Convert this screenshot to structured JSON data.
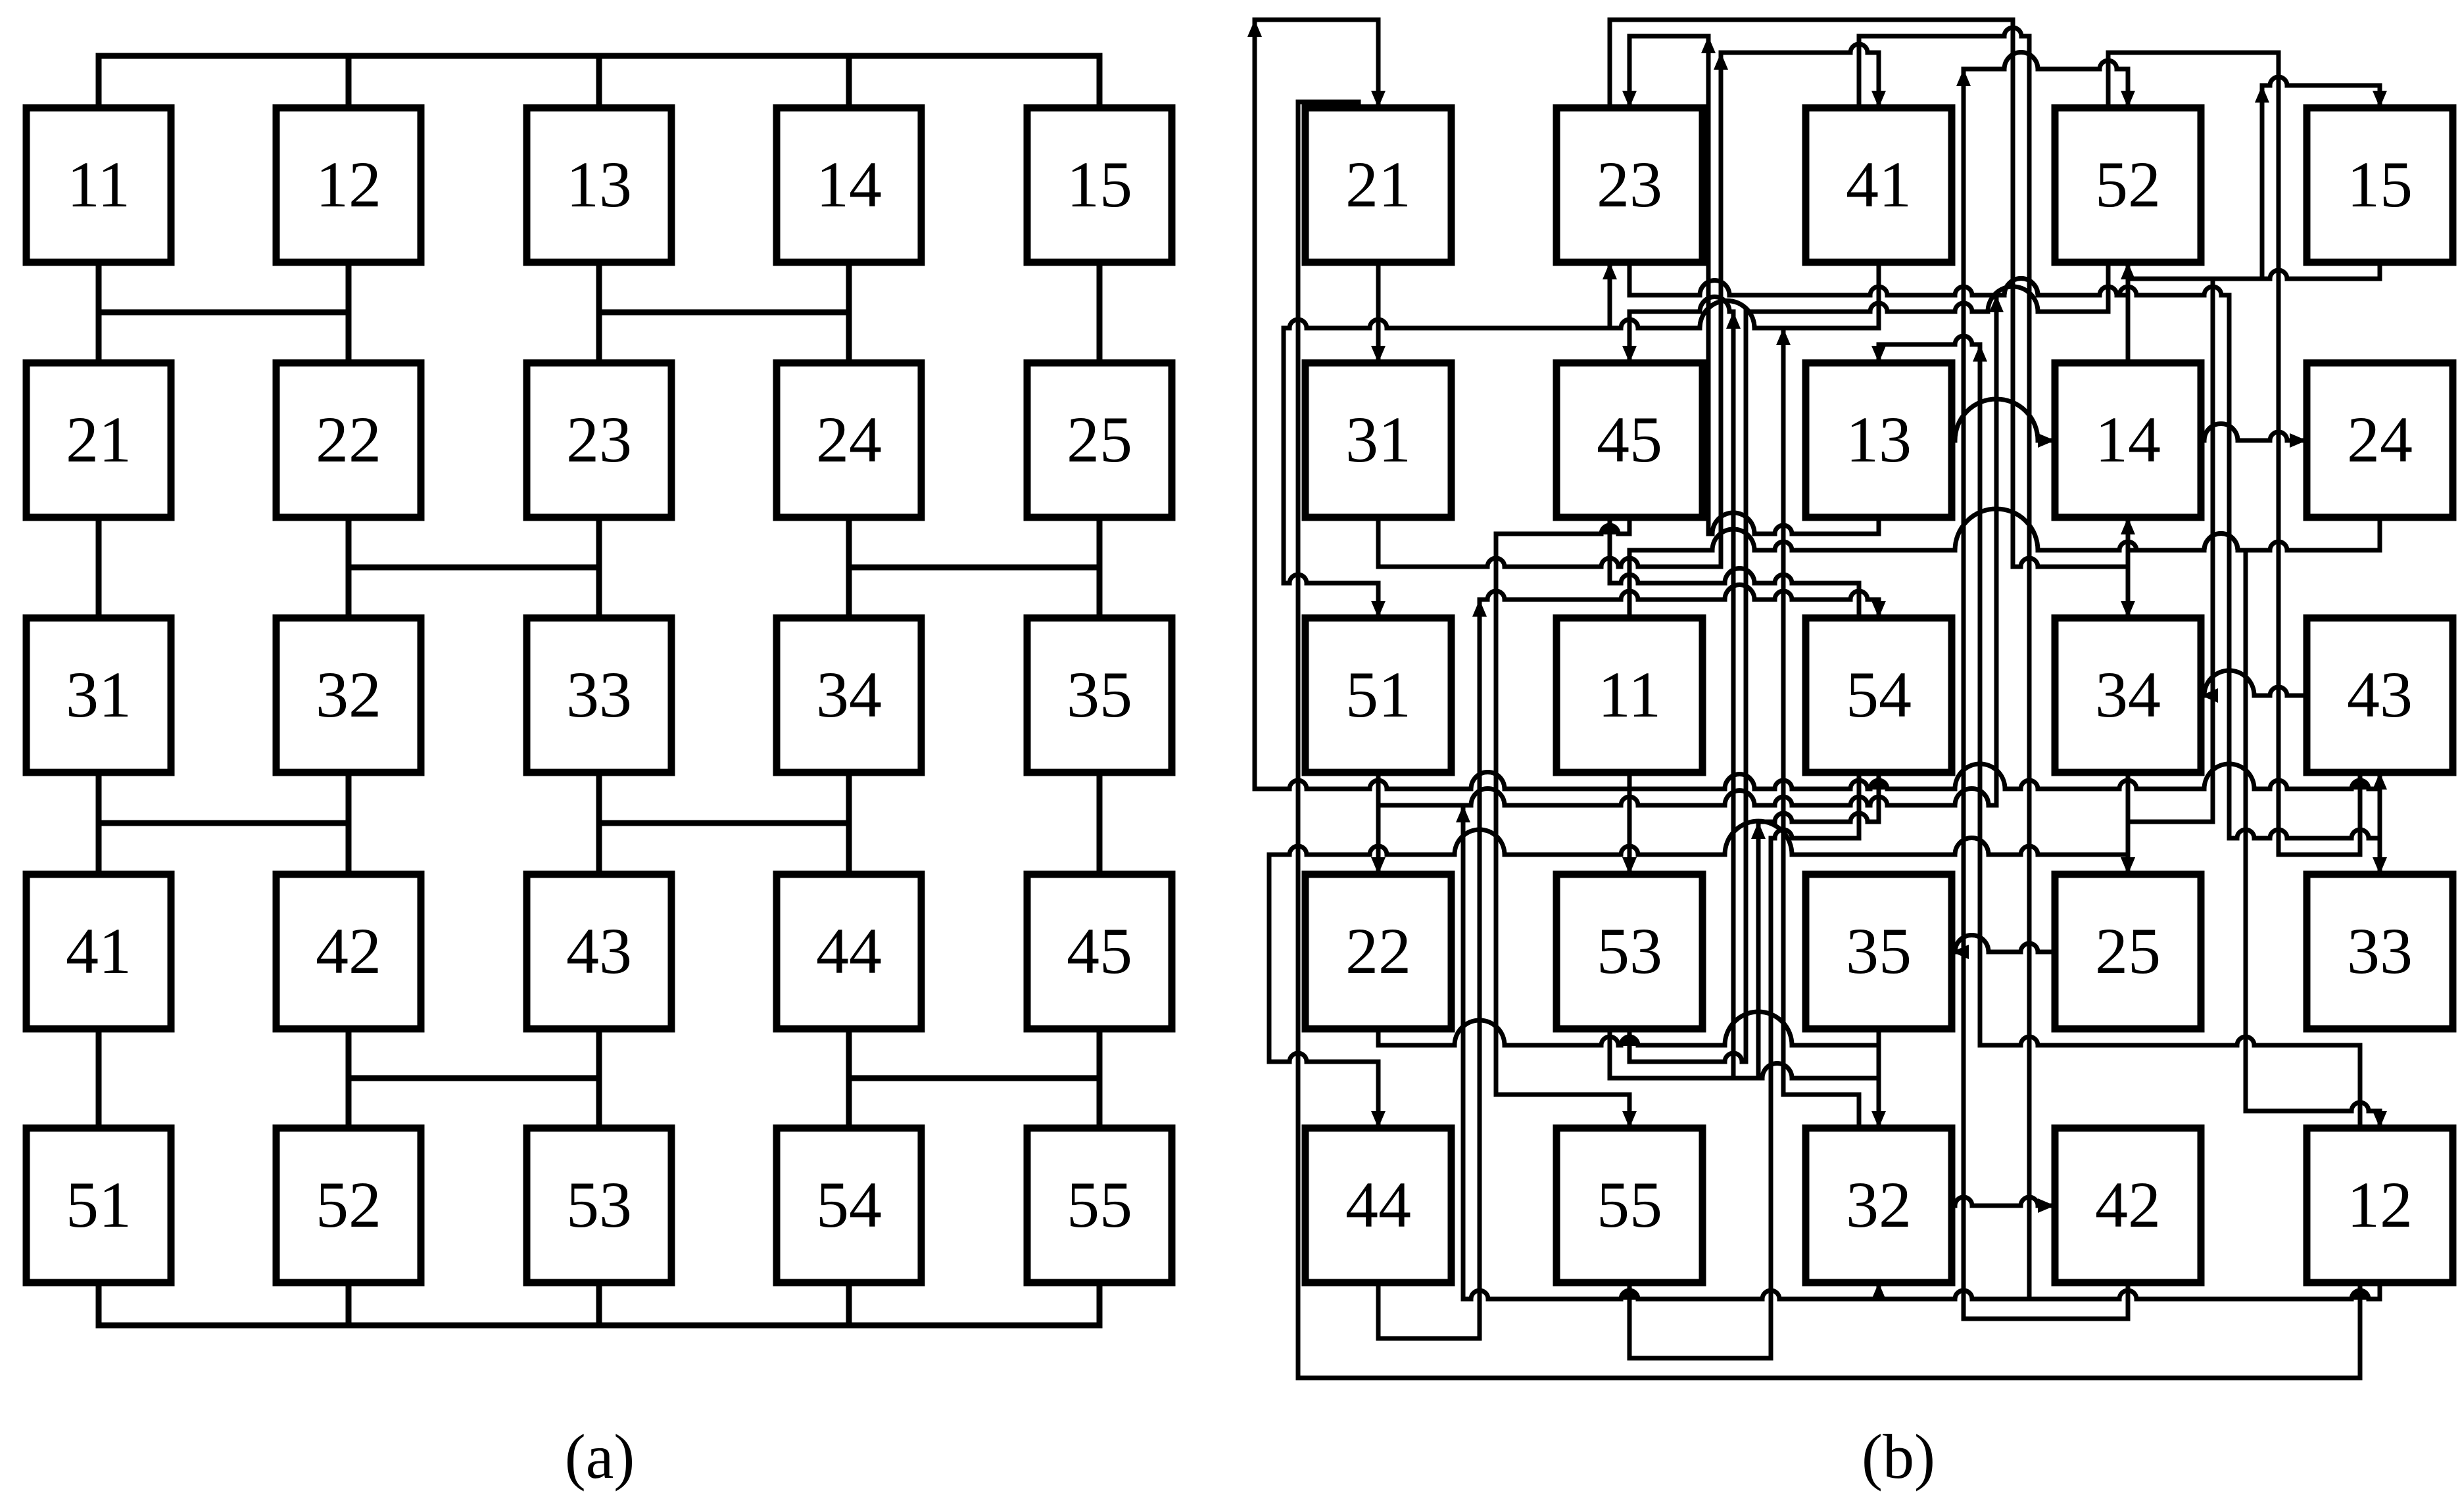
{
  "figure": {
    "caption_a": "(a)",
    "caption_b": "(b)"
  },
  "colors": {
    "ink": "#000000",
    "paper": "#ffffff"
  },
  "diagram_a": {
    "grid": [
      [
        "11",
        "12",
        "13",
        "14",
        "15"
      ],
      [
        "21",
        "22",
        "23",
        "24",
        "25"
      ],
      [
        "31",
        "32",
        "33",
        "34",
        "35"
      ],
      [
        "41",
        "42",
        "43",
        "44",
        "45"
      ],
      [
        "51",
        "52",
        "53",
        "54",
        "55"
      ]
    ],
    "top_bus": true,
    "bottom_bus": true,
    "channel_links": [
      [
        [
          0,
          1
        ],
        [
          2,
          3
        ]
      ],
      [
        [
          1,
          2
        ],
        [
          3,
          4
        ]
      ],
      [
        [
          0,
          1
        ],
        [
          2,
          3
        ]
      ],
      [
        [
          1,
          2
        ],
        [
          3,
          4
        ]
      ]
    ]
  },
  "diagram_b": {
    "grid": [
      [
        "21",
        "23",
        "41",
        "52",
        "15"
      ],
      [
        "31",
        "45",
        "13",
        "14",
        "24"
      ],
      [
        "51",
        "11",
        "54",
        "34",
        "43"
      ],
      [
        "22",
        "53",
        "35",
        "25",
        "33"
      ],
      [
        "44",
        "55",
        "32",
        "42",
        "12"
      ]
    ],
    "edges": [
      {
        "f": "11",
        "t": "21",
        "fp": "bottom",
        "tp": "top"
      },
      {
        "f": "12",
        "t": "22",
        "fp": "bottom",
        "tp": "top"
      },
      {
        "f": "13",
        "t": "23",
        "fp": "bottom",
        "tp": "top"
      },
      {
        "f": "14",
        "t": "24",
        "fp": "bottom",
        "tp": "top"
      },
      {
        "f": "15",
        "t": "25",
        "fp": "bottom",
        "tp": "top"
      },
      {
        "f": "21",
        "t": "31",
        "fp": "bottom",
        "tp": "top"
      },
      {
        "f": "22",
        "t": "32",
        "fp": "bottom",
        "tp": "top"
      },
      {
        "f": "23",
        "t": "33",
        "fp": "bottom",
        "tp": "top"
      },
      {
        "f": "24",
        "t": "34",
        "fp": "bottom",
        "tp": "top"
      },
      {
        "f": "25",
        "t": "35",
        "fp": "bottom",
        "tp": "top"
      },
      {
        "f": "31",
        "t": "41",
        "fp": "bottom",
        "tp": "top"
      },
      {
        "f": "32",
        "t": "42",
        "fp": "bottom",
        "tp": "top"
      },
      {
        "f": "33",
        "t": "43",
        "fp": "bottom",
        "tp": "top"
      },
      {
        "f": "34",
        "t": "44",
        "fp": "bottom",
        "tp": "top"
      },
      {
        "f": "35",
        "t": "45",
        "fp": "bottom",
        "tp": "top"
      },
      {
        "f": "41",
        "t": "51",
        "fp": "bottom",
        "tp": "top"
      },
      {
        "f": "42",
        "t": "52",
        "fp": "bottom",
        "tp": "top"
      },
      {
        "f": "43",
        "t": "53",
        "fp": "bottom",
        "tp": "top"
      },
      {
        "f": "44",
        "t": "54",
        "fp": "bottom",
        "tp": "top"
      },
      {
        "f": "45",
        "t": "55",
        "fp": "bottom",
        "tp": "top"
      },
      {
        "f": "11",
        "t": "12",
        "fp": "top",
        "tp": "top"
      },
      {
        "f": "12",
        "t": "13",
        "fp": "top",
        "tp": "top"
      },
      {
        "f": "13",
        "t": "14",
        "fp": "top",
        "tp": "top"
      },
      {
        "f": "14",
        "t": "15",
        "fp": "top",
        "tp": "top"
      },
      {
        "f": "51",
        "t": "52",
        "fp": "bottom",
        "tp": "bottom"
      },
      {
        "f": "52",
        "t": "53",
        "fp": "bottom",
        "tp": "bottom"
      },
      {
        "f": "53",
        "t": "54",
        "fp": "bottom",
        "tp": "bottom"
      },
      {
        "f": "54",
        "t": "55",
        "fp": "bottom",
        "tp": "bottom"
      },
      {
        "f": "21",
        "t": "12",
        "fp": "top",
        "tp": "bottom"
      },
      {
        "f": "23",
        "t": "14",
        "fp": "top",
        "tp": "bottom"
      },
      {
        "f": "32",
        "t": "23",
        "fp": "top",
        "tp": "bottom"
      },
      {
        "f": "34",
        "t": "25",
        "fp": "top",
        "tp": "bottom"
      },
      {
        "f": "41",
        "t": "32",
        "fp": "top",
        "tp": "bottom"
      },
      {
        "f": "43",
        "t": "34",
        "fp": "top",
        "tp": "bottom"
      },
      {
        "f": "52",
        "t": "43",
        "fp": "top",
        "tp": "bottom"
      },
      {
        "f": "54",
        "t": "45",
        "fp": "top",
        "tp": "bottom"
      }
    ]
  }
}
